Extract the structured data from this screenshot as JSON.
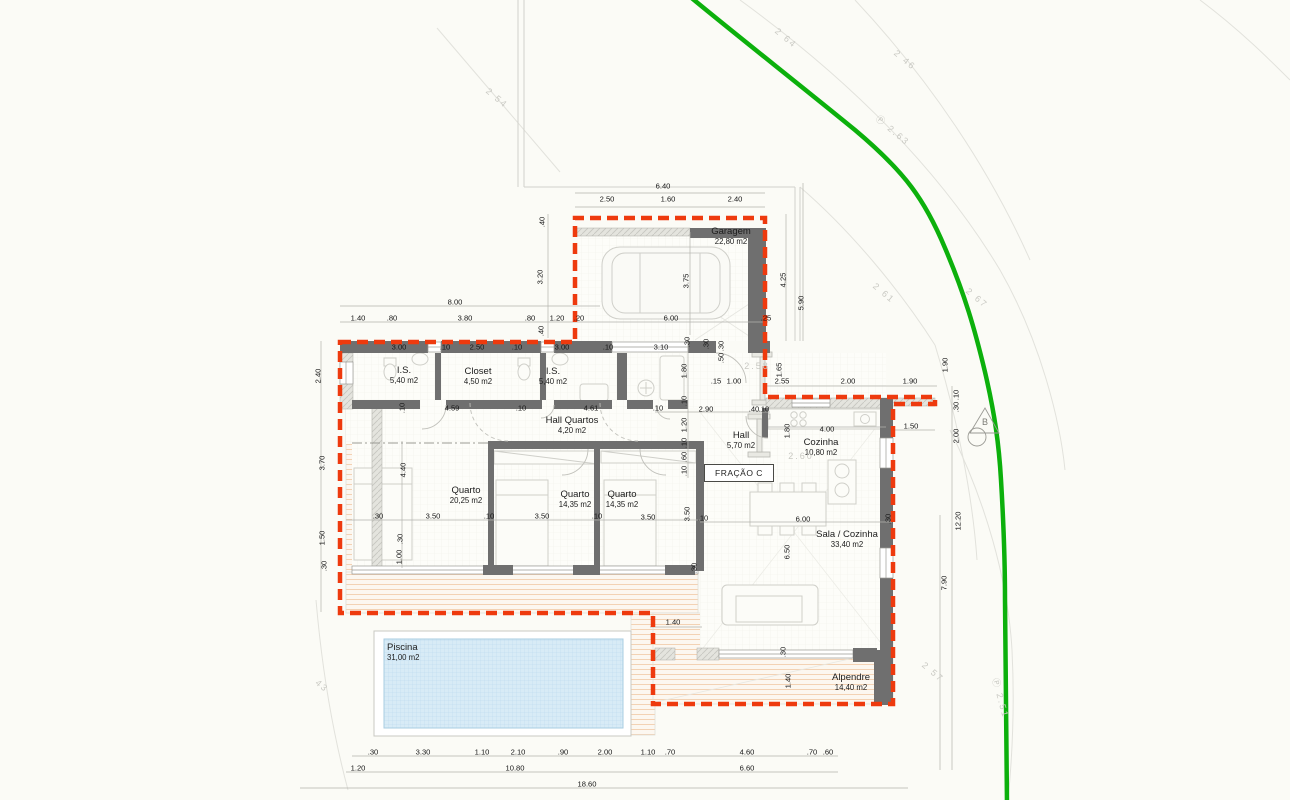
{
  "colors": {
    "outline_red": "#ee3a0e",
    "boundary_green": "#0cb00c",
    "wall": "#6f6f6f",
    "wall_light": "#d7d7d1",
    "pool_water": "#d8ebf6",
    "pool_grid": "#b9d8ec",
    "deck_line": "#f3d2b4",
    "dim_line": "#b2b2ac",
    "contour": "#e2e2dc",
    "furniture": "#cfcfc9"
  },
  "rooms": [
    {
      "name": "Garagem",
      "area": "22,80 m2",
      "x": 731,
      "y": 226
    },
    {
      "name": "I.S.",
      "area": "5,40 m2",
      "x": 404,
      "y": 365
    },
    {
      "name": "Closet",
      "area": "4,50 m2",
      "x": 478,
      "y": 366
    },
    {
      "name": "I.S.",
      "area": "5,40 m2",
      "x": 553,
      "y": 366
    },
    {
      "name": "Hall Quartos",
      "area": "4,20 m2",
      "x": 572,
      "y": 415
    },
    {
      "name": "Hall",
      "area": "5,70 m2",
      "x": 741,
      "y": 430
    },
    {
      "name": "Cozinha",
      "area": "10,80 m2",
      "x": 821,
      "y": 437
    },
    {
      "name": "Quarto",
      "area": "20,25 m2",
      "x": 466,
      "y": 485
    },
    {
      "name": "Quarto",
      "area": "14,35 m2",
      "x": 575,
      "y": 489
    },
    {
      "name": "Quarto",
      "area": "14,35 m2",
      "x": 622,
      "y": 489
    },
    {
      "name": "Sala / Cozinha",
      "area": "33,40 m2",
      "x": 847,
      "y": 529
    },
    {
      "name": "Alpendre",
      "area": "14,40 m2",
      "x": 851,
      "y": 672
    },
    {
      "name": "Piscina",
      "area": "31,00 m2",
      "x": 387,
      "y": 642,
      "align": "left"
    }
  ],
  "dims": [
    {
      "t": "6.40",
      "x": 663,
      "y": 186
    },
    {
      "t": "2.50",
      "x": 607,
      "y": 199
    },
    {
      "t": "1.60",
      "x": 668,
      "y": 199
    },
    {
      "t": "2.40",
      "x": 735,
      "y": 199
    },
    {
      "t": ".40",
      "x": 542,
      "y": 222,
      "r": -90
    },
    {
      "t": "3.20",
      "x": 540,
      "y": 277,
      "r": -90
    },
    {
      "t": ".40",
      "x": 541,
      "y": 331,
      "r": -90
    },
    {
      "t": "3.75",
      "x": 686,
      "y": 281,
      "r": -90
    },
    {
      "t": "4.25",
      "x": 783,
      "y": 280,
      "r": -90
    },
    {
      "t": "5.90",
      "x": 801,
      "y": 303,
      "r": -90
    },
    {
      "t": "8.00",
      "x": 455,
      "y": 302
    },
    {
      "t": "1.40",
      "x": 358,
      "y": 318
    },
    {
      "t": ".80",
      "x": 392,
      "y": 318
    },
    {
      "t": "3.80",
      "x": 465,
      "y": 318
    },
    {
      "t": ".80",
      "x": 530,
      "y": 318
    },
    {
      "t": "1.20",
      "x": 557,
      "y": 318
    },
    {
      "t": ".20",
      "x": 579,
      "y": 318
    },
    {
      "t": "6.00",
      "x": 671,
      "y": 318
    },
    {
      "t": ".25",
      "x": 766,
      "y": 318
    },
    {
      "t": "3.00",
      "x": 399,
      "y": 347
    },
    {
      "t": ".10",
      "x": 445,
      "y": 347
    },
    {
      "t": "2.50",
      "x": 477,
      "y": 347
    },
    {
      "t": ".10",
      "x": 517,
      "y": 347
    },
    {
      "t": "3.00",
      "x": 562,
      "y": 347
    },
    {
      "t": ".10",
      "x": 608,
      "y": 347
    },
    {
      "t": "3.10",
      "x": 661,
      "y": 347
    },
    {
      "t": ".30",
      "x": 706,
      "y": 344,
      "r": -90
    },
    {
      "t": ".30",
      "x": 721,
      "y": 346,
      "r": -90
    },
    {
      "t": ".50",
      "x": 721,
      "y": 358,
      "r": -90
    },
    {
      "t": ".30",
      "x": 687,
      "y": 342,
      "r": -90
    },
    {
      "t": "1.80",
      "x": 684,
      "y": 371,
      "r": -90
    },
    {
      "t": ".10",
      "x": 684,
      "y": 401,
      "r": -90
    },
    {
      "t": "1.20",
      "x": 684,
      "y": 425,
      "r": -90
    },
    {
      "t": ".10",
      "x": 684,
      "y": 443,
      "r": -90
    },
    {
      "t": ".60",
      "x": 684,
      "y": 457,
      "r": -90
    },
    {
      "t": ".10",
      "x": 684,
      "y": 471,
      "r": -90
    },
    {
      "t": ".15",
      "x": 716,
      "y": 381
    },
    {
      "t": "1.00",
      "x": 734,
      "y": 381
    },
    {
      "t": "1.65",
      "x": 779,
      "y": 370,
      "r": -90
    },
    {
      "t": "2.55",
      "x": 782,
      "y": 381
    },
    {
      "t": "2.00",
      "x": 848,
      "y": 381
    },
    {
      "t": "1.90",
      "x": 910,
      "y": 381
    },
    {
      "t": "1.90",
      "x": 945,
      "y": 365,
      "r": -90
    },
    {
      "t": ".10",
      "x": 956,
      "y": 395,
      "r": -90
    },
    {
      "t": ".30",
      "x": 956,
      "y": 407,
      "r": -90
    },
    {
      "t": ".10",
      "x": 402,
      "y": 408,
      "r": -90
    },
    {
      "t": "4.59",
      "x": 452,
      "y": 408
    },
    {
      "t": ".10",
      "x": 521,
      "y": 408
    },
    {
      "t": "4.61",
      "x": 591,
      "y": 408
    },
    {
      "t": ".10",
      "x": 658,
      "y": 408
    },
    {
      "t": "2.90",
      "x": 706,
      "y": 409
    },
    {
      "t": ".40",
      "x": 754,
      "y": 409
    },
    {
      "t": ".10",
      "x": 764,
      "y": 409
    },
    {
      "t": "1.80",
      "x": 787,
      "y": 431,
      "r": -90
    },
    {
      "t": "4.00",
      "x": 827,
      "y": 429
    },
    {
      "t": "1.50",
      "x": 911,
      "y": 426
    },
    {
      "t": "2.00",
      "x": 956,
      "y": 436,
      "r": -90
    },
    {
      "t": "2.40",
      "x": 318,
      "y": 376,
      "r": -90
    },
    {
      "t": "3.70",
      "x": 322,
      "y": 463,
      "r": -90
    },
    {
      "t": "1.50",
      "x": 322,
      "y": 538,
      "r": -90
    },
    {
      "t": ".30",
      "x": 324,
      "y": 566,
      "r": -90
    },
    {
      "t": "4.40",
      "x": 403,
      "y": 470,
      "r": -90
    },
    {
      "t": ".30",
      "x": 400,
      "y": 539,
      "r": -90
    },
    {
      "t": "1.00",
      "x": 399,
      "y": 557,
      "r": -90
    },
    {
      "t": ".30",
      "x": 378,
      "y": 516
    },
    {
      "t": "3.50",
      "x": 433,
      "y": 516
    },
    {
      "t": ".10",
      "x": 489,
      "y": 516
    },
    {
      "t": "3.50",
      "x": 542,
      "y": 516
    },
    {
      "t": ".10",
      "x": 597,
      "y": 516
    },
    {
      "t": "3.50",
      "x": 648,
      "y": 517
    },
    {
      "t": ".10",
      "x": 703,
      "y": 518
    },
    {
      "t": "3.50",
      "x": 687,
      "y": 514,
      "r": -90
    },
    {
      "t": ".30",
      "x": 694,
      "y": 568,
      "r": -90
    },
    {
      "t": "6.00",
      "x": 803,
      "y": 519
    },
    {
      "t": ".30",
      "x": 888,
      "y": 519,
      "r": -90
    },
    {
      "t": "6.50",
      "x": 787,
      "y": 552,
      "r": -90
    },
    {
      "t": "12.20",
      "x": 958,
      "y": 521,
      "r": -90
    },
    {
      "t": "7.90",
      "x": 944,
      "y": 583,
      "r": -90
    },
    {
      "t": "1.40",
      "x": 673,
      "y": 622
    },
    {
      "t": ".30",
      "x": 783,
      "y": 652,
      "r": -90
    },
    {
      "t": "1.40",
      "x": 788,
      "y": 681,
      "r": -90
    },
    {
      "t": ".30",
      "x": 373,
      "y": 752
    },
    {
      "t": "3.30",
      "x": 423,
      "y": 752
    },
    {
      "t": "1.10",
      "x": 482,
      "y": 752
    },
    {
      "t": "2.10",
      "x": 518,
      "y": 752
    },
    {
      "t": ".90",
      "x": 563,
      "y": 752
    },
    {
      "t": "2.00",
      "x": 605,
      "y": 752
    },
    {
      "t": "1.10",
      "x": 648,
      "y": 752
    },
    {
      "t": ".70",
      "x": 670,
      "y": 752
    },
    {
      "t": "4.60",
      "x": 747,
      "y": 752
    },
    {
      "t": ".70",
      "x": 812,
      "y": 752
    },
    {
      "t": ".60",
      "x": 828,
      "y": 752
    },
    {
      "t": "1.20",
      "x": 358,
      "y": 768
    },
    {
      "t": "10.80",
      "x": 515,
      "y": 768
    },
    {
      "t": "6.60",
      "x": 747,
      "y": 768
    },
    {
      "t": "18.60",
      "x": 587,
      "y": 784
    }
  ],
  "survey": [
    {
      "t": "2 54",
      "x": 497,
      "y": 98,
      "r": 40
    },
    {
      "t": "2 46",
      "x": 905,
      "y": 60,
      "r": 40
    },
    {
      "t": "Ⓟ 2.63",
      "x": 893,
      "y": 130,
      "r": 40
    },
    {
      "t": "2 64",
      "x": 786,
      "y": 38,
      "r": 40
    },
    {
      "t": "2 61",
      "x": 884,
      "y": 293,
      "r": 40
    },
    {
      "t": "2 67",
      "x": 977,
      "y": 298,
      "r": 40
    },
    {
      "t": "2 57",
      "x": 933,
      "y": 672,
      "r": 40
    },
    {
      "t": "43",
      "x": 322,
      "y": 686,
      "r": 40
    },
    {
      "t": "2.58",
      "x": 757,
      "y": 366,
      "r": 0
    },
    {
      "t": "2.60",
      "x": 801,
      "y": 456,
      "r": 0
    },
    {
      "t": "Ⓟ 2.51",
      "x": 1001,
      "y": 698,
      "r": 75
    }
  ],
  "markers": {
    "fracao_label": "FRAÇÃO C",
    "b_label": "B"
  }
}
